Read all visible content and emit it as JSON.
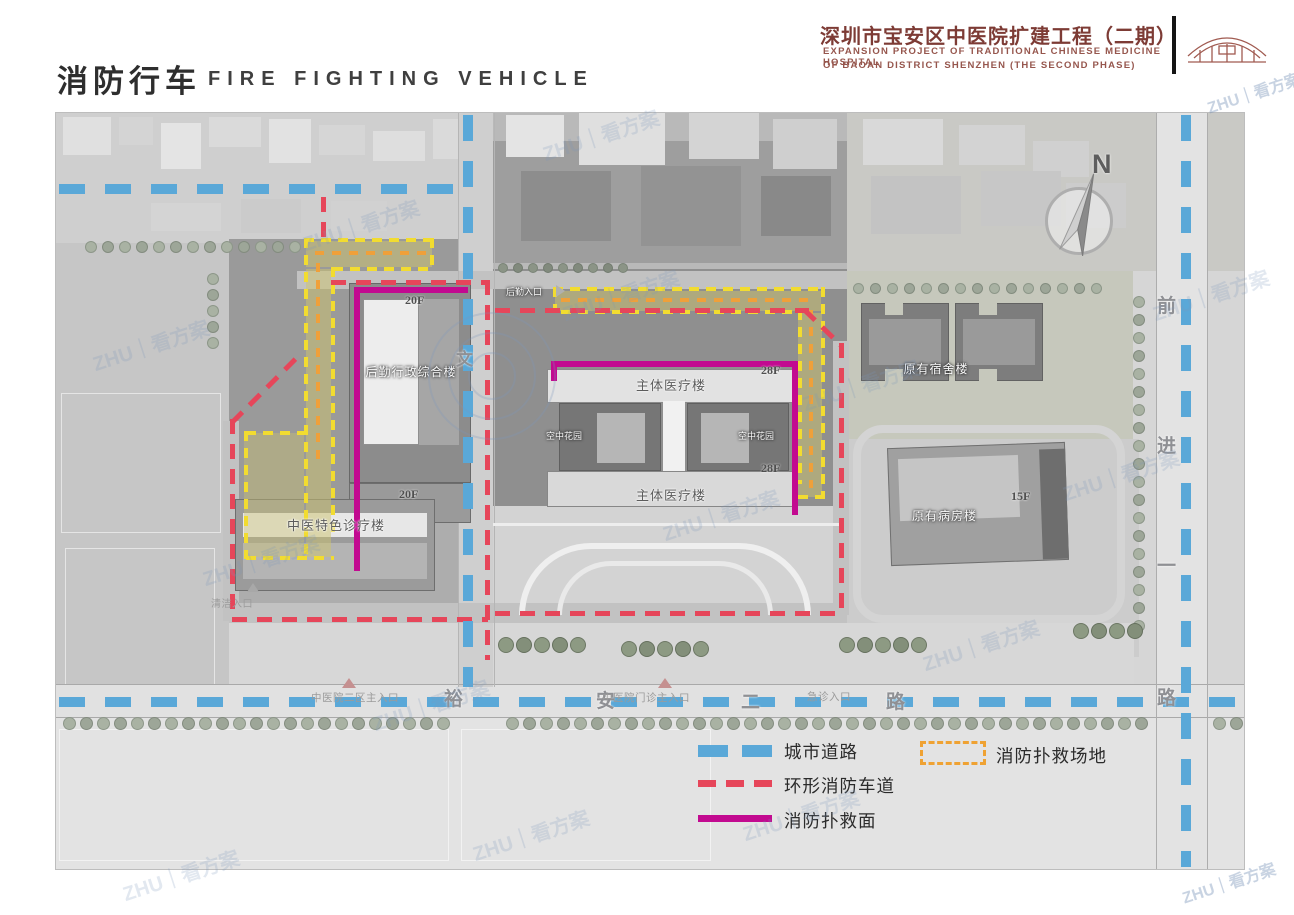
{
  "header": {
    "title_cn": "消防行车",
    "title_en": "FIRE FIGHTING VEHICLE",
    "project": {
      "title_cn": "深圳市宝安区中医院扩建工程（二期）",
      "subtitle_en_line1": "EXPANSION PROJECT OF TRADITIONAL CHINESE MEDICINE HOSPITAL",
      "subtitle_en_line2": "OF BAOAN DISTRICT SHENZHEN (THE SECOND PHASE)",
      "accent_color": "#7d3b35"
    }
  },
  "compass": {
    "north_label": "N"
  },
  "plan": {
    "buildings": {
      "admin": {
        "name": "后勤行政综合楼",
        "floors": "20F"
      },
      "tcm_clinic": {
        "name": "中医特色诊疗楼"
      },
      "main_medical_north": {
        "name": "主体医疗楼",
        "floors": "28F"
      },
      "main_medical_south": {
        "name": "主体医疗楼",
        "floors": "28F"
      },
      "sky_garden_west": {
        "name": "空中花园"
      },
      "sky_garden_east": {
        "name": "空中花园"
      },
      "existing_dormitory": {
        "name": "原有宿舍楼"
      },
      "existing_ward": {
        "name": "原有病房楼",
        "floors": "15F"
      }
    },
    "roads": {
      "south": {
        "name": "裕安二路",
        "chars": [
          "裕",
          "安",
          "二",
          "路"
        ]
      },
      "east": {
        "name": "前进一路",
        "chars": [
          "前",
          "进",
          "一",
          "路"
        ]
      },
      "west_char": "文"
    },
    "entrances": {
      "district2_main": "中医院二区主入口",
      "outpatient_main": "中医院门诊主入口",
      "emergency": "急诊入口",
      "logistics": "后勤入口",
      "cleaning": "清洁入口"
    }
  },
  "legend": {
    "city_road": {
      "label": "城市道路",
      "color": "#5aa8d8"
    },
    "ring_fire_lane": {
      "label": "环形消防车道",
      "color": "#e6465a"
    },
    "rescue_face": {
      "label": "消防扑救面",
      "color": "#c20a90"
    },
    "rescue_site": {
      "label": "消防扑救场地",
      "color": "#efa233"
    }
  },
  "watermark": {
    "text": "ZHU｜看方案"
  }
}
